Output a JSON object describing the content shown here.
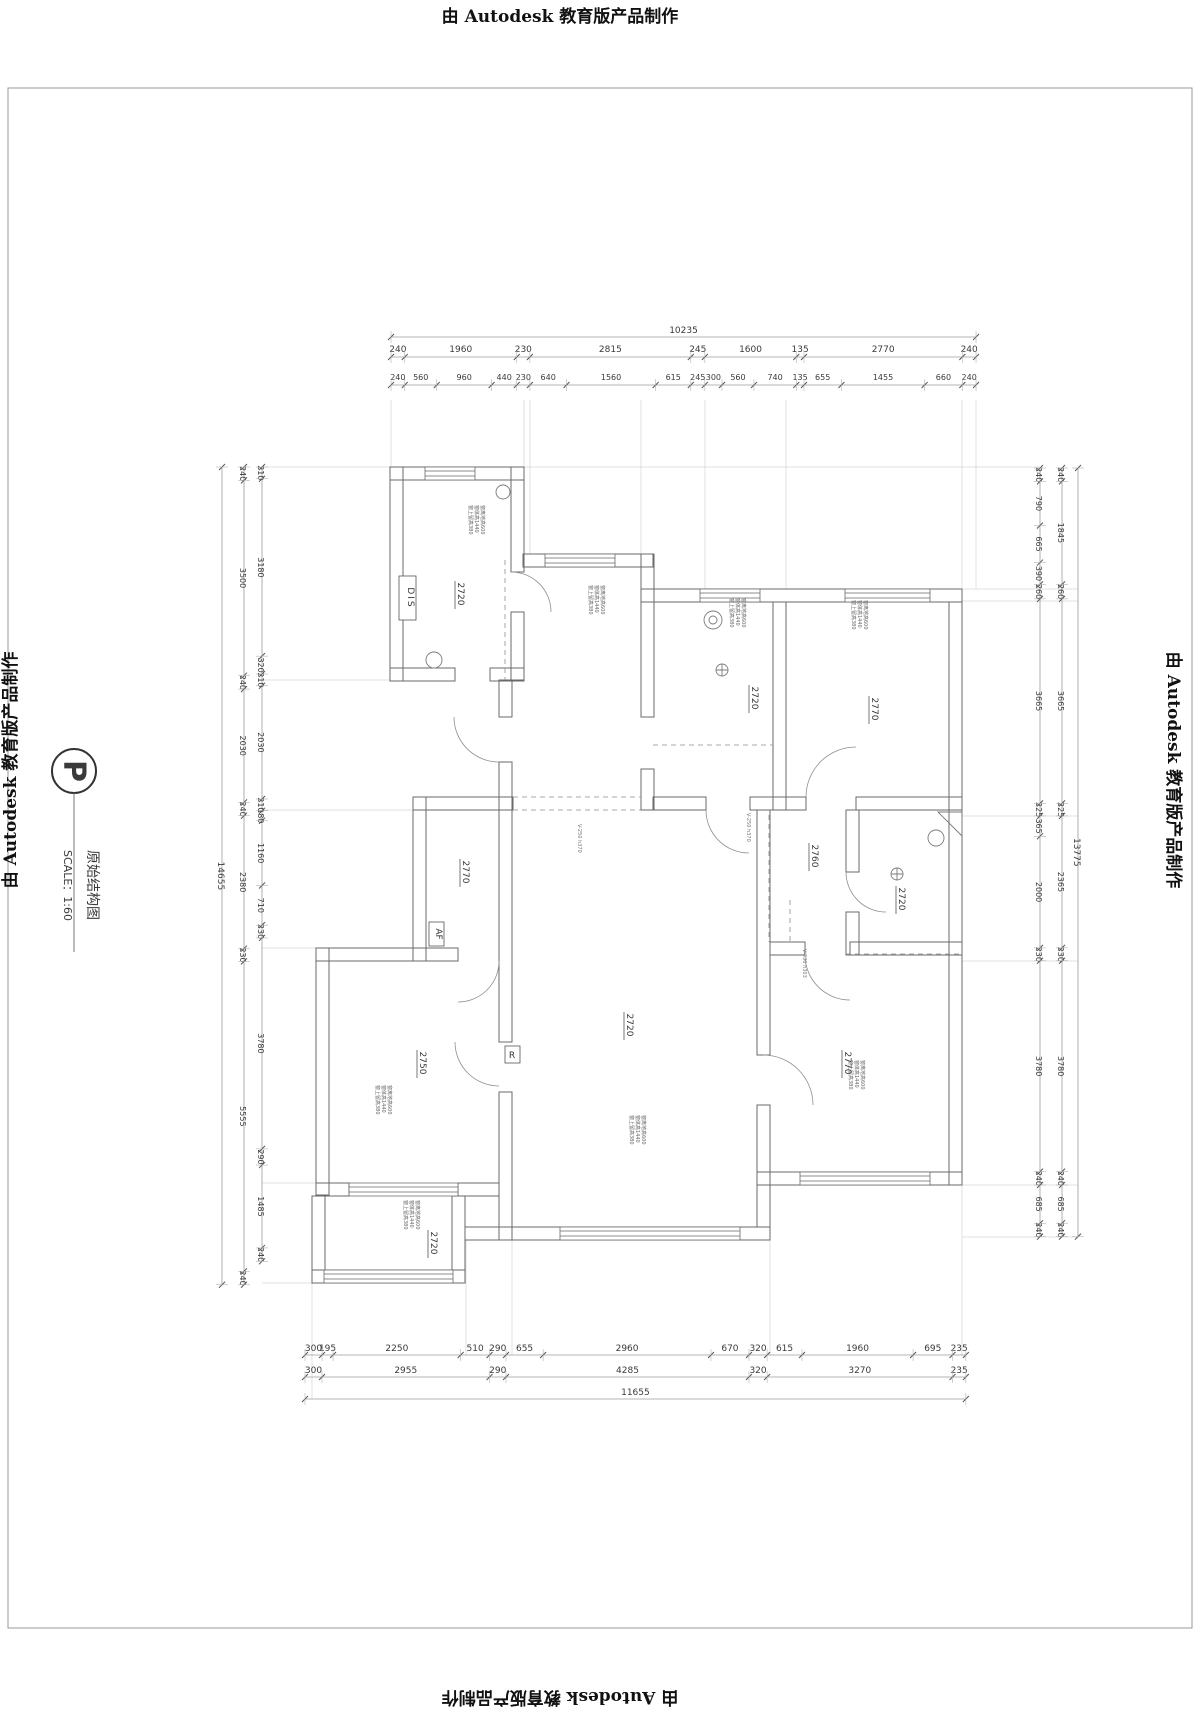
{
  "watermark": "由 Autodesk 教育版产品制作",
  "title_block": {
    "symbol": "P",
    "title": "原始结构图",
    "scale": "SCALE：1:60"
  },
  "dims": {
    "top": {
      "overall": [
        10235
      ],
      "row1": [
        240,
        1960,
        230,
        2815,
        245,
        1600,
        135,
        2770,
        240
      ],
      "row2": [
        240,
        560,
        960,
        440,
        230,
        640,
        1560,
        615,
        245,
        300,
        560,
        740,
        135,
        655,
        1455,
        660,
        240
      ]
    },
    "bottom": {
      "overall": [
        11655
      ],
      "row1": [
        300,
        195,
        2250,
        510,
        290,
        655,
        2960,
        670,
        320,
        615,
        1960,
        695,
        235
      ],
      "row2": [
        300,
        2955,
        290,
        4285,
        320,
        3270,
        235
      ]
    },
    "left": {
      "overall": [
        14655
      ],
      "outer": [
        240,
        3500,
        240,
        2030,
        240,
        2380,
        230,
        5555,
        240
      ],
      "inner": [
        210,
        3180,
        320,
        210,
        2030,
        210,
        180,
        1160,
        710,
        230,
        3780,
        290,
        1485,
        240
      ]
    },
    "right": {
      "overall": [
        13775
      ],
      "outer": [
        240,
        1845,
        260,
        3665,
        225,
        2365,
        230,
        3780,
        240,
        685,
        240
      ],
      "inner": [
        240,
        790,
        665,
        390,
        260,
        3665,
        225,
        365,
        2000,
        230,
        3780,
        240,
        685,
        240
      ]
    }
  },
  "rooms": [
    {
      "name": "entry",
      "elevation": "2720"
    },
    {
      "name": "bath-top",
      "elevation": "2720"
    },
    {
      "name": "bedroom-ne",
      "elevation": "2770"
    },
    {
      "name": "hall-mid",
      "elevation": "2760"
    },
    {
      "name": "bath-right",
      "elevation": "2720"
    },
    {
      "name": "bedroom-west",
      "elevation": "2770"
    },
    {
      "name": "living",
      "elevation": "2720"
    },
    {
      "name": "bedroom-sw",
      "elevation": "2750"
    },
    {
      "name": "bedroom-se",
      "elevation": "2770"
    },
    {
      "name": "balcony",
      "elevation": "2720"
    }
  ],
  "plan_labels": {
    "dis": "DIS",
    "af": "AF",
    "r": "R",
    "v1": "V-250 h370",
    "v2": "V-250 h370",
    "v3": "V-230 h303"
  },
  "window_note": {
    "line1": "窗离地高600",
    "line2": "窗体高1440",
    "line3": "窗上留高380"
  }
}
